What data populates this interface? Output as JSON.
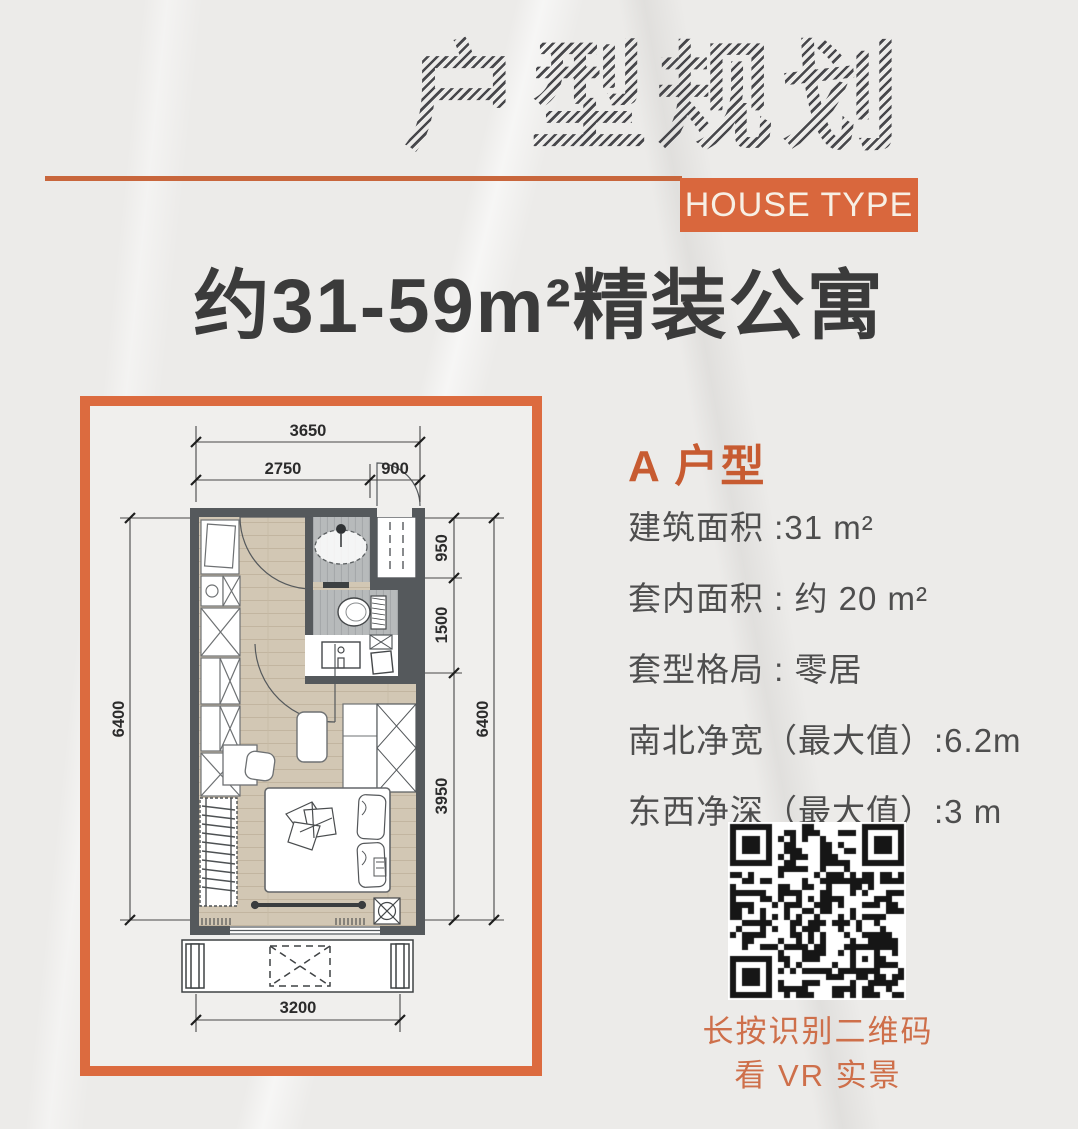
{
  "header": {
    "title_cn": "户型规划",
    "subtitle_en_box": "HOUSE TYPE",
    "tagline": "约31-59m²精装公寓"
  },
  "colors": {
    "accent_orange": "#D9673D",
    "frame_orange": "#DC6B3F",
    "caption_orange": "#CE6F4A",
    "wall_gray": "#55595C",
    "wood_tan": "#D2C7B4",
    "tile_gray": "#B7BABB"
  },
  "floorplan": {
    "dims": {
      "top_total": "3650",
      "top_left": "2750",
      "top_right": "900",
      "left_total": "6400",
      "right_total": "6400",
      "right_seg_1": "950",
      "right_seg_2": "1500",
      "right_seg_3": "3950",
      "bottom": "3200"
    }
  },
  "details": {
    "heading": "A 户型",
    "rows": [
      "建筑面积 :31 m²",
      "套内面积 : 约 20 m²",
      "套型格局 : 零居",
      "南北净宽（最大值）:6.2m",
      "东西净深（最大值）:3 m"
    ]
  },
  "qr": {
    "caption_line1": "长按识别二维码",
    "caption_line2": "看 VR 实景"
  }
}
